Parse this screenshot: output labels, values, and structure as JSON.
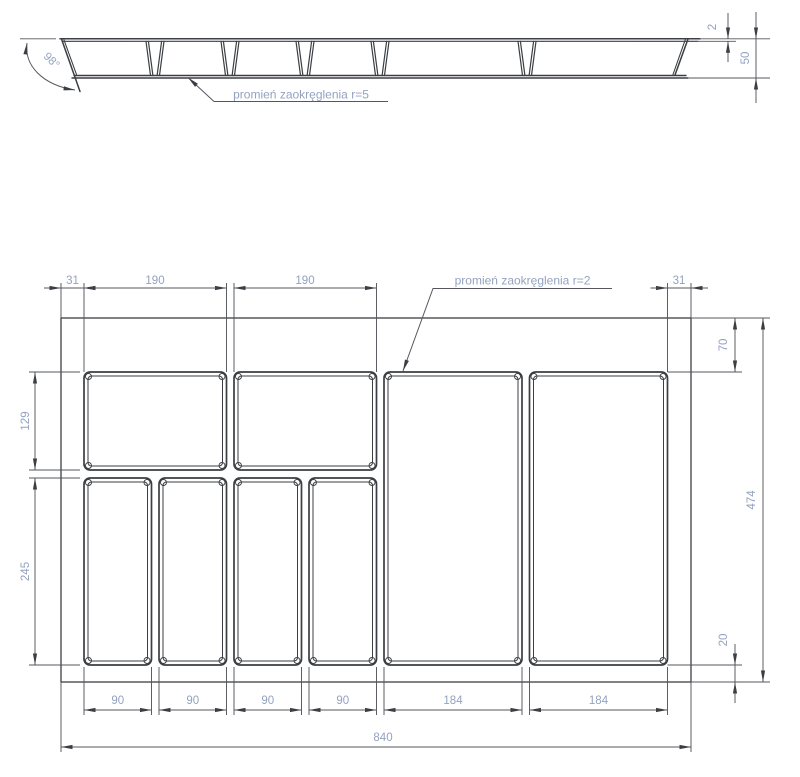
{
  "section": {
    "angle": "98°",
    "rim_thickness": "2",
    "height": "50",
    "radius_note": "promień zaokręglenia r=5"
  },
  "plan": {
    "radius_note": "promień zaokręglenia r=2",
    "top": {
      "margin_left": "31",
      "comp1": "190",
      "comp2": "190",
      "margin_right": "31"
    },
    "left": {
      "row1_height": "129",
      "row2_height": "245"
    },
    "right": {
      "top_offset": "70",
      "total_height": "474",
      "bottom_offset": "20"
    },
    "bottom": {
      "c1": "90",
      "c2": "90",
      "c3": "90",
      "c4": "90",
      "c5": "184",
      "c6": "184",
      "total_width": "840"
    }
  },
  "colors": {
    "line": "#3b3e42",
    "dim_text": "#94a2c0"
  }
}
